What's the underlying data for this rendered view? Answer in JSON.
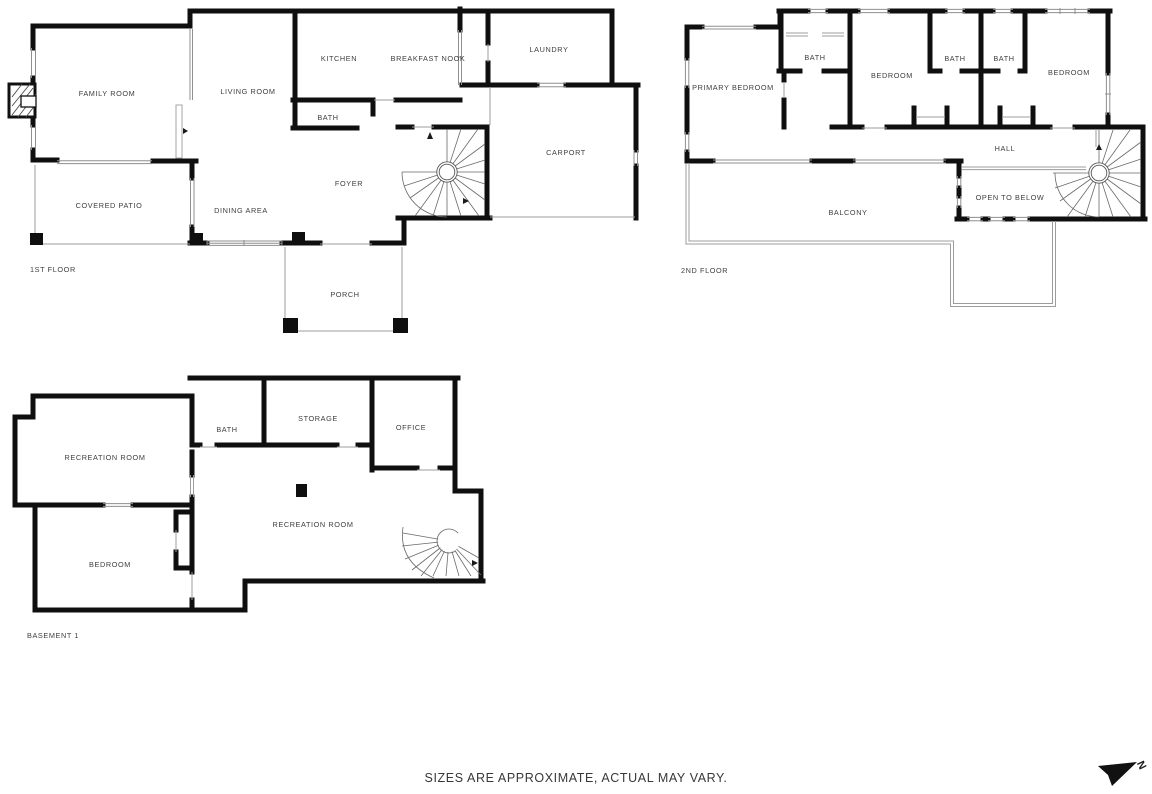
{
  "page": {
    "background": "#ffffff"
  },
  "colors": {
    "wall": "#0f0f0f",
    "thin_line": "#9c9c9c",
    "stair_line": "#6a6a6a",
    "text": "#3e3e3e"
  },
  "footer": {
    "disclaimer": "SIZES ARE APPROXIMATE, ACTUAL MAY VARY."
  },
  "north": {
    "label": "N"
  },
  "floors": [
    {
      "label": "1ST FLOOR",
      "rooms": [
        {
          "label": "FAMILY ROOM"
        },
        {
          "label": "LIVING ROOM"
        },
        {
          "label": "KITCHEN"
        },
        {
          "label": "BREAKFAST NOOK"
        },
        {
          "label": "LAUNDRY"
        },
        {
          "label": "BATH"
        },
        {
          "label": "CARPORT"
        },
        {
          "label": "COVERED PATIO"
        },
        {
          "label": "DINING AREA"
        },
        {
          "label": "FOYER"
        },
        {
          "label": "PORCH"
        }
      ]
    },
    {
      "label": "2ND FLOOR",
      "rooms": [
        {
          "label": "PRIMARY BEDROOM"
        },
        {
          "label": "BATH"
        },
        {
          "label": "BEDROOM"
        },
        {
          "label": "BATH"
        },
        {
          "label": "BATH"
        },
        {
          "label": "BEDROOM"
        },
        {
          "label": "HALL"
        },
        {
          "label": "OPEN TO BELOW"
        },
        {
          "label": "BALCONY"
        }
      ]
    },
    {
      "label": "BASEMENT 1",
      "rooms": [
        {
          "label": "RECREATION ROOM"
        },
        {
          "label": "BATH"
        },
        {
          "label": "STORAGE"
        },
        {
          "label": "OFFICE"
        },
        {
          "label": "BEDROOM"
        },
        {
          "label": "RECREATION ROOM"
        }
      ]
    }
  ]
}
